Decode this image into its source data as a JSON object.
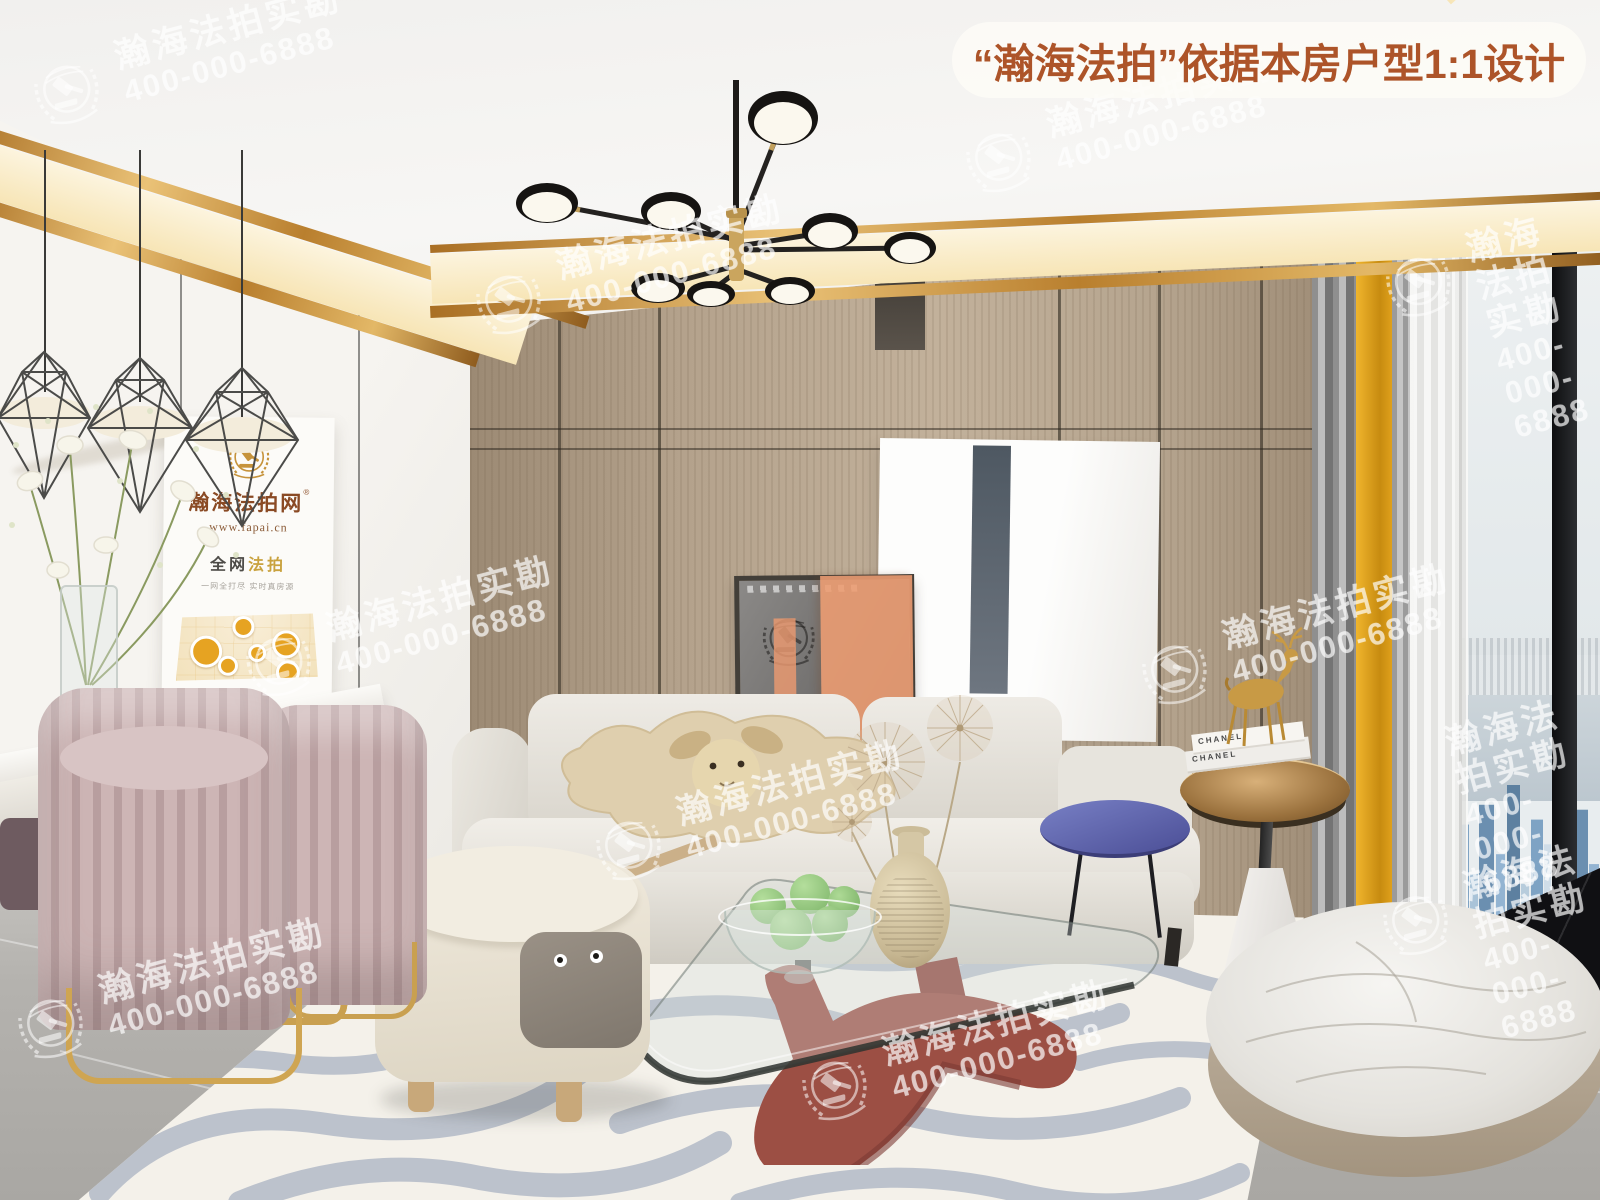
{
  "banner": {
    "text": "“瀚海法拍”依据本房户型1:1设计"
  },
  "watermark": {
    "line1": "瀚海法拍实勘",
    "line2": "400-000-6888"
  },
  "poster": {
    "title": "瀚海法拍网",
    "registered_mark": "®",
    "url": "www.fapai.cn",
    "slogan_prefix": "全网",
    "slogan_accent": "法拍",
    "tagline": "一网全打尽 实时真房源"
  },
  "books": {
    "spine1": "CHANEL",
    "spine2": "CHANEL"
  },
  "colors": {
    "banner_text": "#ad5429",
    "gold_trim": "#c89243",
    "cove_glow": "#f7e5b6",
    "wood_wall": "#b4a28c",
    "poster_gold": "#c6933b",
    "poster_brown": "#8a4a24",
    "curtain_yellow": "#e2a31f",
    "coffee_table_base": "#9c4f44",
    "blue_side_table": "#5f63ad",
    "watermark": "#ffffff"
  }
}
